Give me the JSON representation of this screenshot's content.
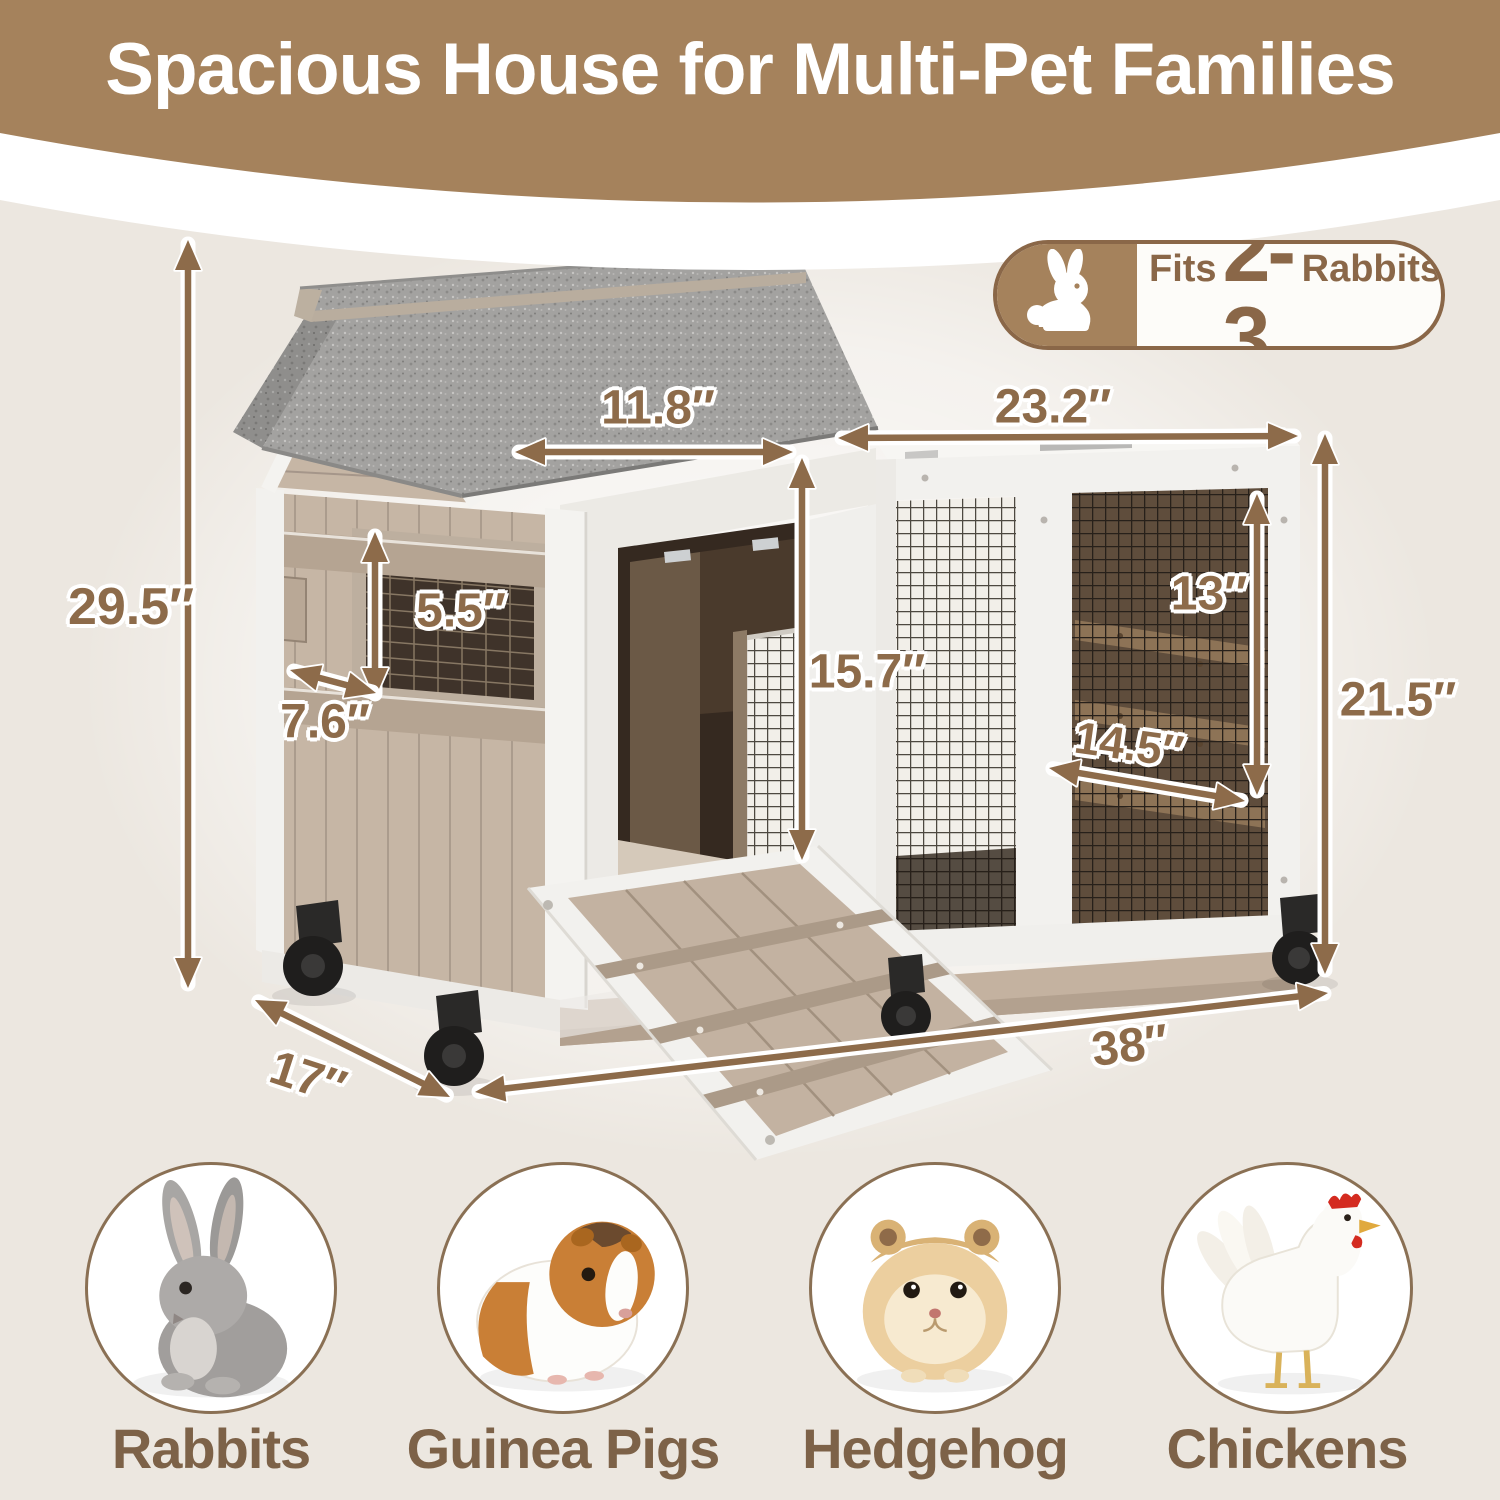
{
  "header": {
    "title": "Spacious House for Multi-Pet Families"
  },
  "badge": {
    "icon": "rabbit-icon",
    "fits_label": "Fits",
    "count": "2-3",
    "animal_label": "Rabbits"
  },
  "dimensions": {
    "overall_height": "29.5″",
    "door_width": "11.8″",
    "run_top_width": "23.2″",
    "window_height": "5.5″",
    "window_width": "7.6″",
    "door_height": "15.7″",
    "run_door_height": "13″",
    "run_door_width": "14.5″",
    "run_height": "21.5″",
    "overall_length": "38″",
    "overall_depth": "17″"
  },
  "pets": {
    "items": [
      {
        "icon": "rabbit-icon",
        "label": "Rabbits"
      },
      {
        "icon": "guinea-pig-icon",
        "label": "Guinea Pigs"
      },
      {
        "icon": "hamster-icon",
        "label": "Hedgehog"
      },
      {
        "icon": "chicken-icon",
        "label": "Chickens"
      }
    ]
  },
  "colors": {
    "background": "#ece7e0",
    "banner_brown": "#a5825c",
    "dimension_text": "#8d6b4a",
    "pet_label_brown": "#7d6248",
    "badge_accent": "#8a6748",
    "roof_gray": "#a3a2a0",
    "wood_tan": "#c6b6a5",
    "frame_white": "#f2f1ee",
    "arrow_brown": "#8d6b4a"
  }
}
